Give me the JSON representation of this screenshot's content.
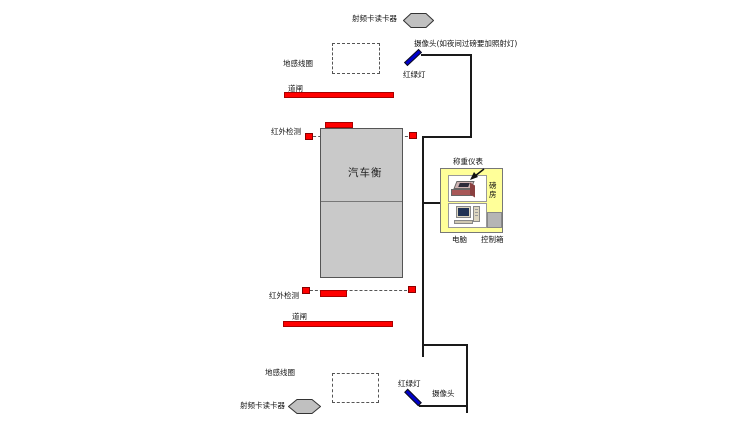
{
  "labels": {
    "top_rfid": "射频卡读卡器",
    "top_camera": "摄像头(如夜间过磅要加照射灯)",
    "top_loop": "地感线圈",
    "top_light": "红绿灯",
    "top_barrier": "道闸",
    "top_infrared": "红外检测",
    "scale": "汽车衡",
    "indicator": "称重仪表",
    "weigh_house": "磅房",
    "computer": "电脑",
    "control_box": "控制箱",
    "bottom_infrared": "红外检测",
    "bottom_barrier": "道闸",
    "bottom_loop": "地感线圈",
    "bottom_rfid": "射频卡读卡器",
    "bottom_light": "红绿灯",
    "bottom_camera": "摄像头"
  },
  "colors": {
    "barrier_red": "#ff0000",
    "traffic_light_blue": "#0000cc",
    "scale_gray": "#c9c9c9",
    "hexagon_gray": "#c0c0c0",
    "weigh_house_yellow": "#ffff99",
    "line_black": "#1a1a1a",
    "background": "#ffffff"
  }
}
